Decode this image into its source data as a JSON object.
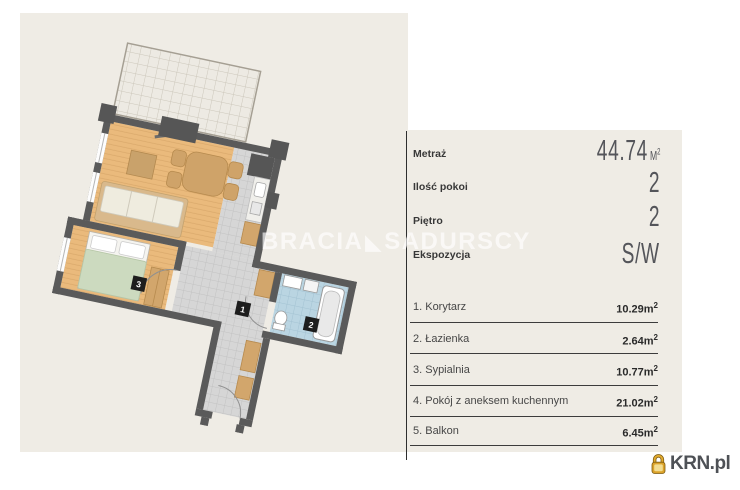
{
  "watermark": {
    "part1": "BRACIA",
    "separator": "◣",
    "part2": "SADURSCY"
  },
  "floorplan": {
    "labels": [
      "1",
      "2",
      "3"
    ],
    "legend": {
      "1": "Korytarz",
      "2": "Łazienka",
      "3": "Sypialnia"
    }
  },
  "panel": {
    "specs": [
      {
        "label": "Metraż",
        "value": "44.74",
        "unit_base": "M",
        "unit_sup": "2"
      },
      {
        "label": "Ilość pokoi",
        "value": "2"
      },
      {
        "label": "Piętro",
        "value": "2"
      },
      {
        "label": "Ekspozycja",
        "value": "S/W"
      }
    ],
    "rooms": [
      {
        "label": "1. Korytarz",
        "area": "10.29"
      },
      {
        "label": "2. Łazienka",
        "area": "2.64"
      },
      {
        "label": "3. Sypialnia",
        "area": "10.77"
      },
      {
        "label": "4. Pokój z aneksem kuchennym",
        "area": "21.02"
      },
      {
        "label": "5. Balkon",
        "area": "6.45"
      }
    ],
    "area_unit_base": "m",
    "area_unit_sup": "2"
  },
  "logo": {
    "text": "KRN.pl"
  },
  "colors": {
    "background_beige": "#efece5",
    "wall": "#5a5a5a",
    "wood_floor": "#eaba7c",
    "tile_gray": "#d6d6d6",
    "bathroom_blue": "#bad5e2",
    "balcony": "#edeae3",
    "bed_blanket": "#ccdabf",
    "furniture_tan": "#cfa369",
    "label_black": "#1d1d1d",
    "logo_gold": "#dca32a",
    "panel_text": "#383838",
    "big_value_gray": "#54555a"
  }
}
